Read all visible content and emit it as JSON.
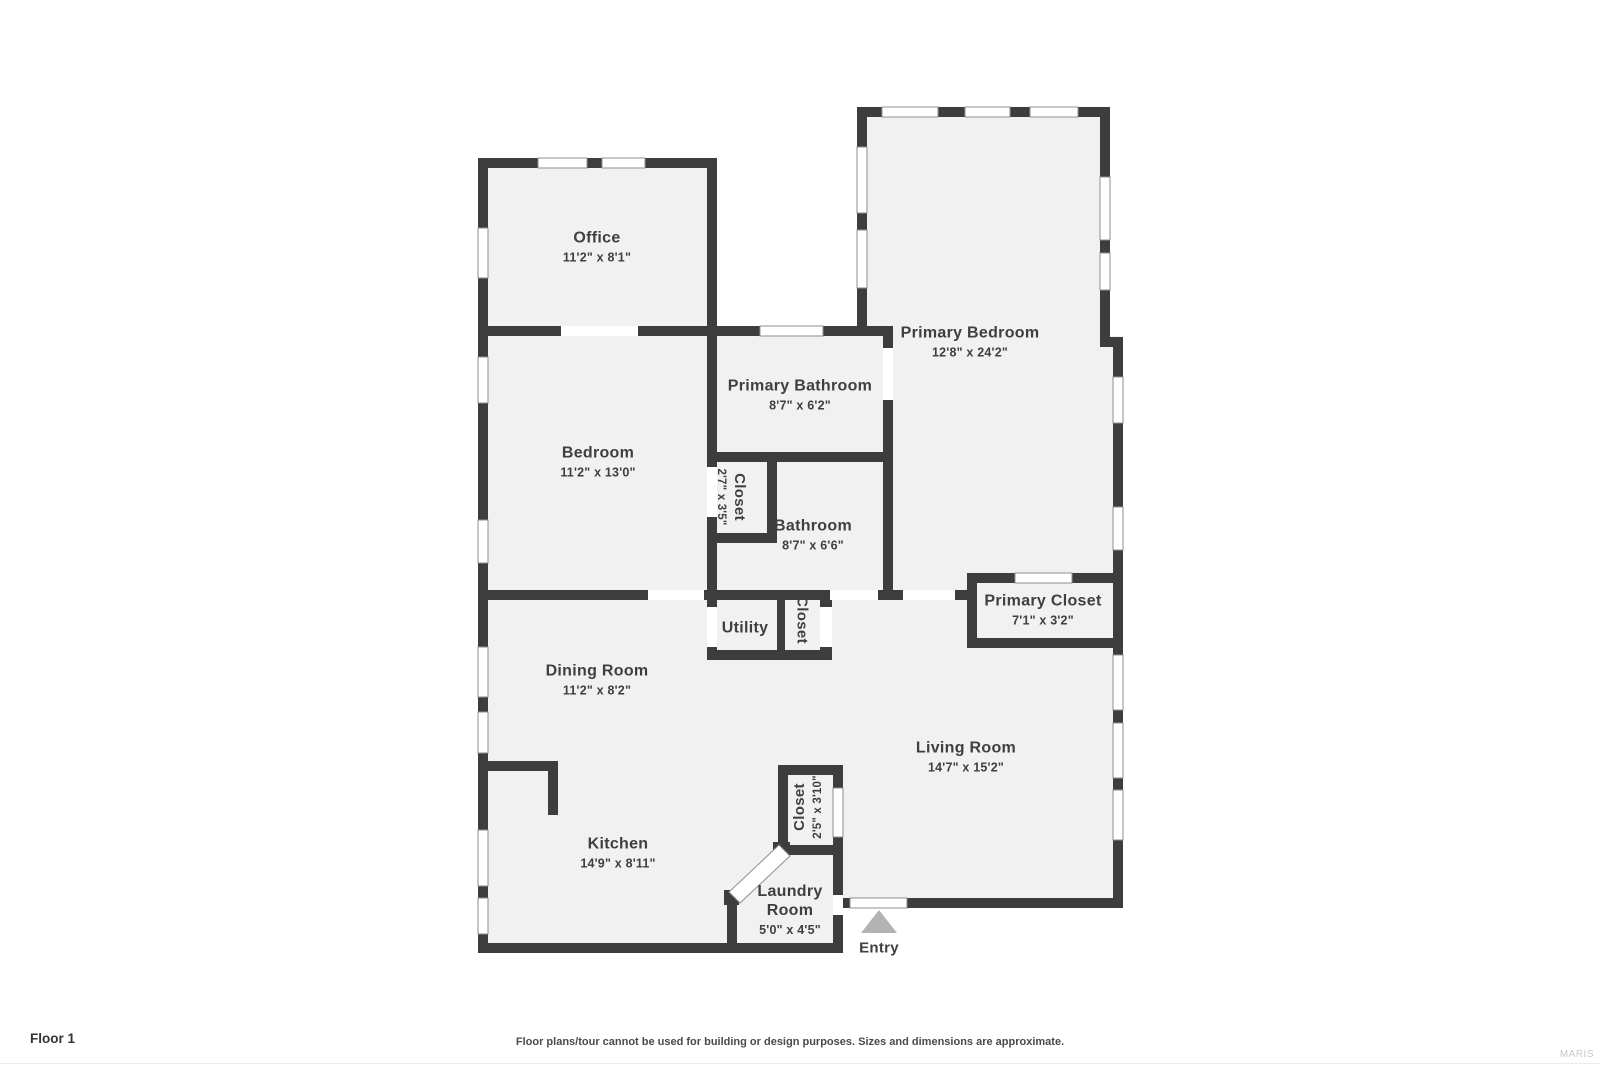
{
  "floor_label": "Floor 1",
  "disclaimer": "Floor plans/tour cannot be used for building or design purposes. Sizes and dimensions are approximate.",
  "watermark": "MARIS",
  "entry_label": "Entry",
  "rooms": {
    "office": {
      "name": "Office",
      "dims": "11'2\" x 8'1\""
    },
    "primary_bedroom": {
      "name": "Primary Bedroom",
      "dims": "12'8\" x 24'2\""
    },
    "primary_bathroom": {
      "name": "Primary Bathroom",
      "dims": "8'7\" x 6'2\""
    },
    "bedroom": {
      "name": "Bedroom",
      "dims": "11'2\" x 13'0\""
    },
    "closet_small": {
      "name": "Closet",
      "dims": "2'7\" x 3'5\""
    },
    "bathroom": {
      "name": "Bathroom",
      "dims": "8'7\" x 6'6\""
    },
    "utility": {
      "name": "Utility"
    },
    "hall_closet": {
      "name": "Closet"
    },
    "primary_closet": {
      "name": "Primary Closet",
      "dims": "7'1\" x 3'2\""
    },
    "dining_room": {
      "name": "Dining Room",
      "dims": "11'2\" x 8'2\""
    },
    "living_room": {
      "name": "Living Room",
      "dims": "14'7\" x 15'2\""
    },
    "kitchen": {
      "name": "Kitchen",
      "dims": "14'9\" x 8'11\""
    },
    "laundry_closet": {
      "name": "Closet",
      "dims": "2'5\" x 3'10\""
    },
    "laundry_room": {
      "name": "Laundry Room",
      "dims": "5'0\" x 4'5\""
    }
  },
  "colors": {
    "wall": "#3d3d3d",
    "floor": "#f1f1f1",
    "background": "#ffffff",
    "entry_marker": "#b1b3b5",
    "window_outline": "#8f8f8f",
    "label_text": "#3f3f3f"
  }
}
